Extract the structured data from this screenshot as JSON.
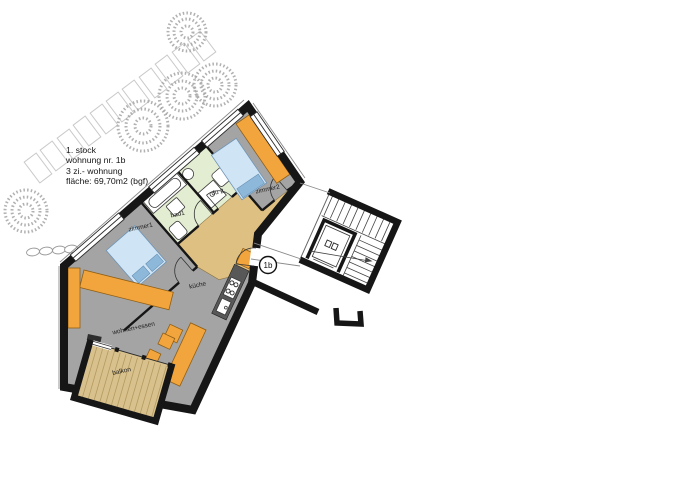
{
  "title_block": {
    "line1": "1. stock",
    "line2": "wohnung nr. 1b",
    "line3": "3 zi.- wohnung",
    "line4": "fläche: 69,70m2 (bgf)"
  },
  "unit_badge": {
    "label": "1b"
  },
  "rooms": {
    "zimmer1": "zimmer1",
    "bad1": "bad1",
    "du2": "du 2",
    "zimmer2": "zimmer2",
    "kueche": "küche",
    "wohnen_essen": "wohnen+essen",
    "balkon": "balkon"
  },
  "colors": {
    "wall": "#161616",
    "floor": "#a4a4a4",
    "bath": "#e3edd2",
    "wood": "#dfc083",
    "balcony": "#d8c18c",
    "balcony_stripe": "#b49a60",
    "furniture": "#f3a53d",
    "furniture_edge": "#8f5f16",
    "bed": "#cfe4f4",
    "pillow": "#8db8da",
    "counter": "#585858",
    "tree": "#a3a3a3",
    "paver": "#c9c9c9"
  }
}
